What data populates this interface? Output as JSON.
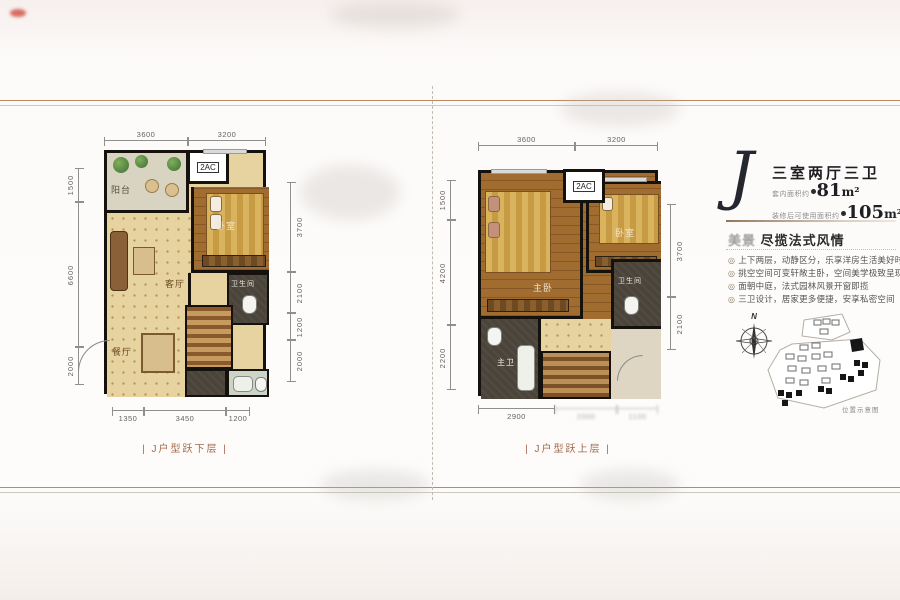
{
  "info": {
    "letter": "J",
    "title": "三室两厅三卫",
    "area_rows": [
      {
        "label": "套内面积约",
        "num": "81",
        "unit": "m²"
      },
      {
        "label": "装修后可使用面积约",
        "num": "105",
        "unit": "m²"
      }
    ],
    "slogan_prefix": "美景",
    "slogan_main": " 尽揽法式风情",
    "bullet_icon": "◎",
    "bullets": [
      "上下两层，动静区分，乐享洋房生活美好时光",
      "挑空空间可变轩敞主卧，空间美学极致呈现",
      "面朝中庭，法式园林风景开窗即揽",
      "三卫设计，居家更多便捷，安享私密空间"
    ],
    "compass_label": "N",
    "map_caption": "位置示意图"
  },
  "plan_lower": {
    "caption": "| J户型跃下层 |",
    "ac_label": "2AC",
    "rooms": {
      "balcony": "阳台",
      "living": "客厅",
      "bedroom": "卧室",
      "dining": "餐厅",
      "bath": "卫生间"
    },
    "dims": {
      "top": [
        "3600",
        "3200"
      ],
      "left": [
        "1500",
        "6600",
        "2000"
      ],
      "right": [
        "3700",
        "2100",
        "1200",
        "2000"
      ],
      "bottom": [
        "1350",
        "3450",
        "1200"
      ]
    }
  },
  "plan_upper": {
    "caption": "| J户型跃上层 |",
    "ac_label": "2AC",
    "rooms": {
      "master": "主卧",
      "bedroom": "卧室",
      "master_bath": "主卫",
      "bath": "卫生间"
    },
    "dims": {
      "top": [
        "3600",
        "3200"
      ],
      "left": [
        "1500",
        "4200",
        "2200"
      ],
      "right": [
        "3700",
        "2100"
      ],
      "bottom": [
        "2900",
        "2000",
        "1100"
      ]
    }
  }
}
